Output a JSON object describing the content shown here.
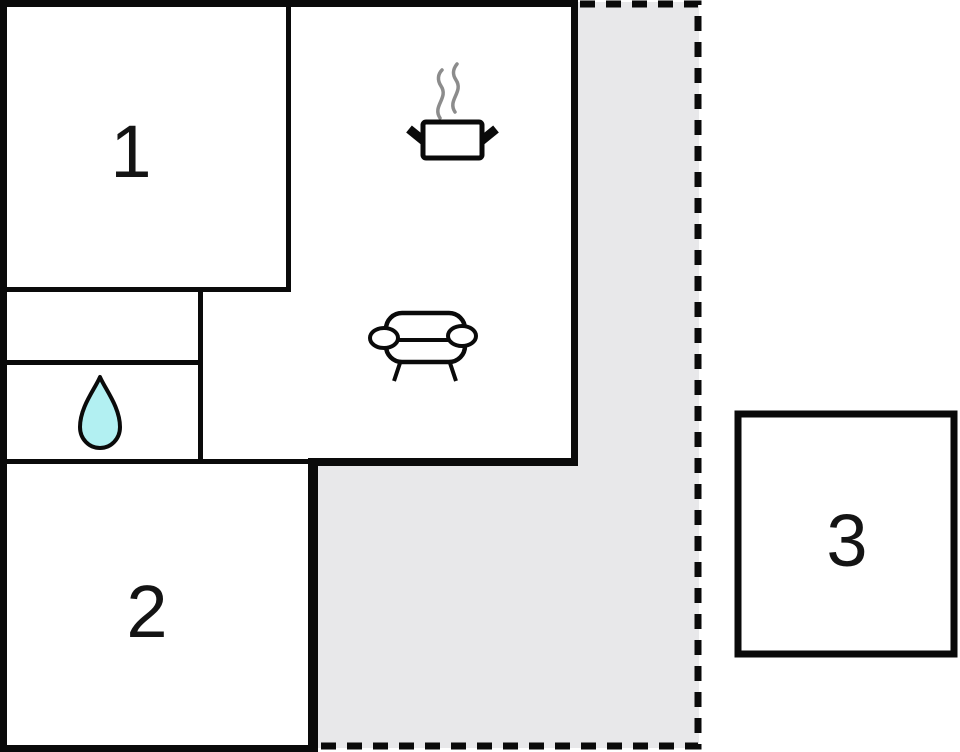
{
  "floorplan": {
    "title": "apartment-floor-plan",
    "rooms": {
      "room1": {
        "label": "1",
        "type": "bedroom"
      },
      "room2": {
        "label": "2",
        "type": "bedroom"
      },
      "room3": {
        "label": "3",
        "type": "annex"
      }
    },
    "icons": {
      "kitchen": "cooking-pot-with-steam-icon",
      "living": "sofa-icon",
      "bathroom": "water-drop-icon"
    },
    "colors": {
      "wall": "#0a0a0a",
      "terrace": "#e8e8ea",
      "water": "#b2f0f2",
      "steam": "#8c8c8c",
      "room_fill": "#ffffff"
    }
  }
}
